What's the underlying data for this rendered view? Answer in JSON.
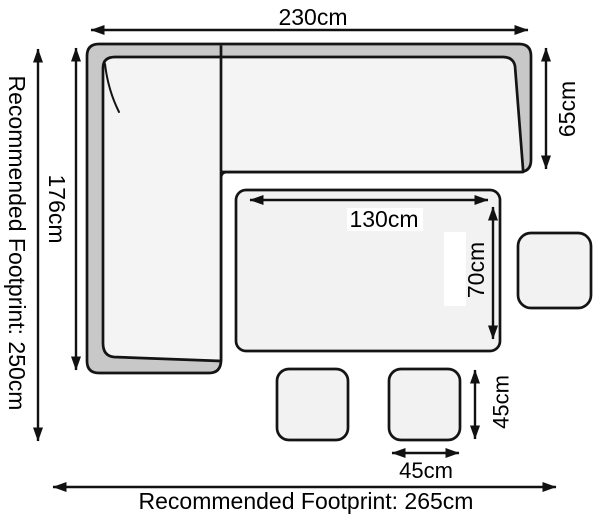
{
  "diagram": {
    "type": "furniture-footprint-dimension-diagram",
    "labels": {
      "sofa_width": "230cm",
      "sofa_left_depth": "176cm",
      "sofa_right_depth": "65cm",
      "table_length": "130cm",
      "table_depth": "70cm",
      "stool_depth": "45cm",
      "stool_width": "45cm",
      "footprint_left": "Recommended Footprint: 250cm",
      "footprint_bottom": "Recommended Footprint: 265cm"
    },
    "colors": {
      "background": "#ffffff",
      "outline": "#141414",
      "arrow": "#111111",
      "sofa_band": "#c8c8c8",
      "sofa_cushion": "#f4f4f4",
      "table_fill": "#f2f2f2",
      "stool_fill": "#f2f2f2",
      "label_background": "#ffffff"
    }
  }
}
